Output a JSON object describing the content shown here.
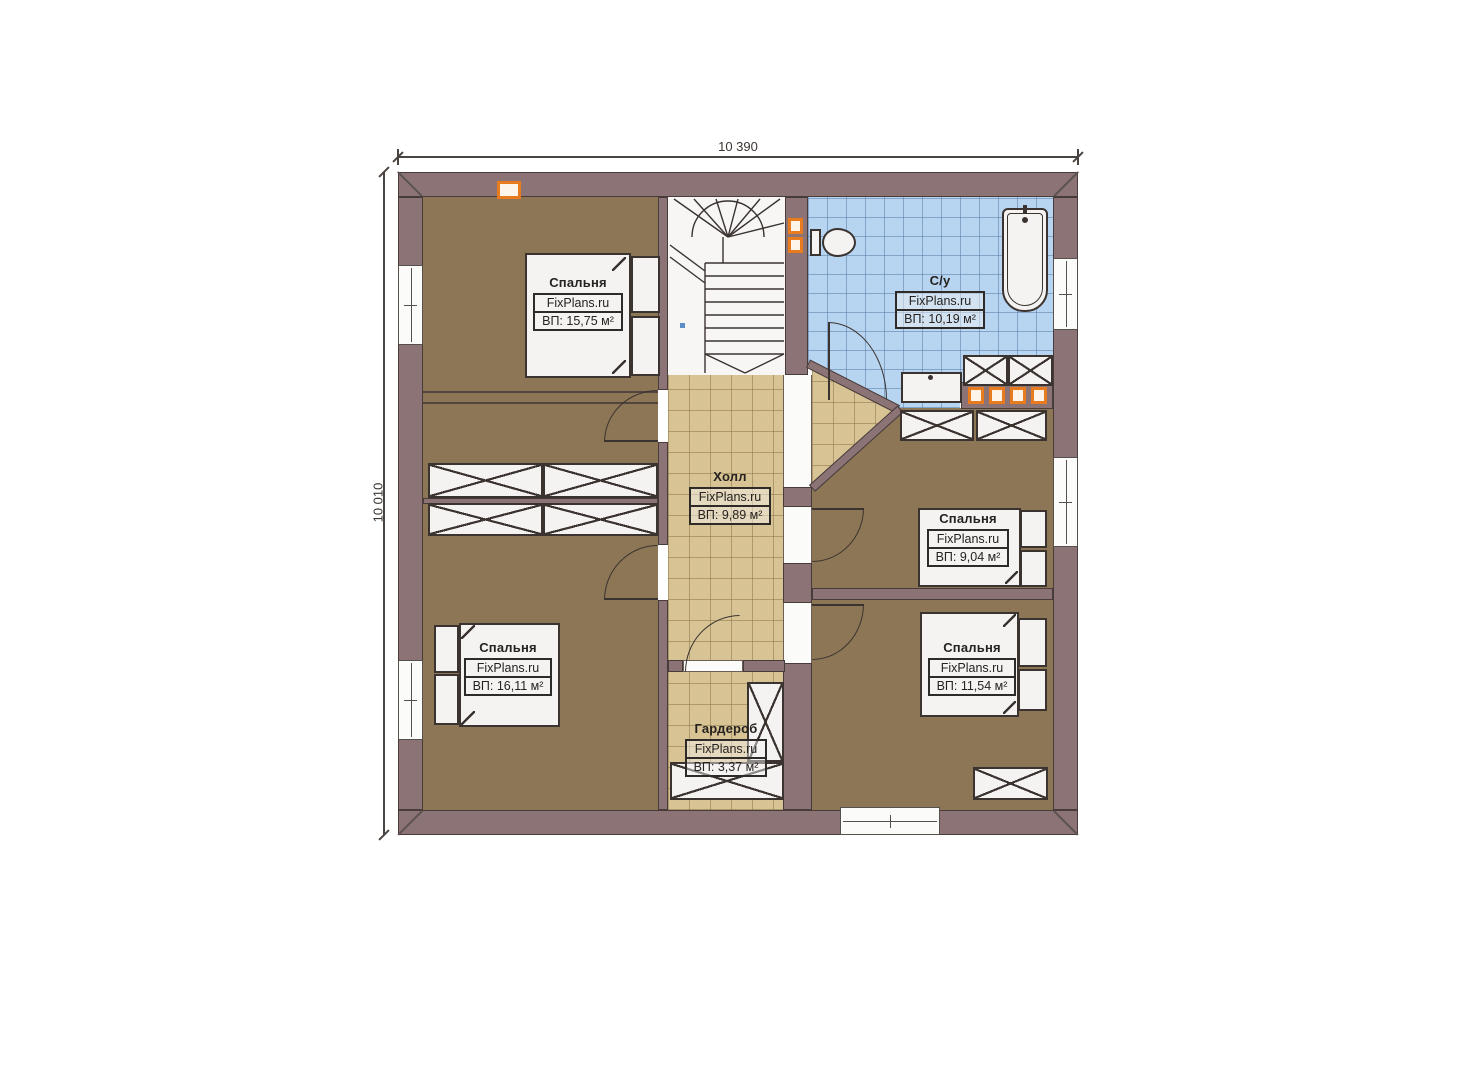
{
  "dimensions": {
    "width_label": "10 390",
    "height_label": "10 010"
  },
  "rooms": [
    {
      "key": "bedroom-top-left",
      "name": "Спальня",
      "brand": "FixPlans.ru",
      "area": "ВП: 15,75 м²"
    },
    {
      "key": "bathroom",
      "name": "С/у",
      "brand": "FixPlans.ru",
      "area": "ВП: 10,19 м²"
    },
    {
      "key": "hall",
      "name": "Холл",
      "brand": "FixPlans.ru",
      "area": "ВП: 9,89 м²"
    },
    {
      "key": "bedroom-right-middle",
      "name": "Спальня",
      "brand": "FixPlans.ru",
      "area": "ВП: 9,04 м²"
    },
    {
      "key": "bedroom-bottom-left",
      "name": "Спальня",
      "brand": "FixPlans.ru",
      "area": "ВП: 16,11 м²"
    },
    {
      "key": "bedroom-bottom-right",
      "name": "Спальня",
      "brand": "FixPlans.ru",
      "area": "ВП: 11,54 м²"
    },
    {
      "key": "wardrobe",
      "name": "Гардероб",
      "brand": "FixPlans.ru",
      "area": "ВП: 3,37 м²"
    }
  ],
  "colors": {
    "wall": "#8c7376",
    "bedroom_floor": "#8d7656",
    "hall_tile": "#d8c395",
    "bathroom_tile": "#b7d4f0",
    "accent_orange": "#e87b1e"
  }
}
